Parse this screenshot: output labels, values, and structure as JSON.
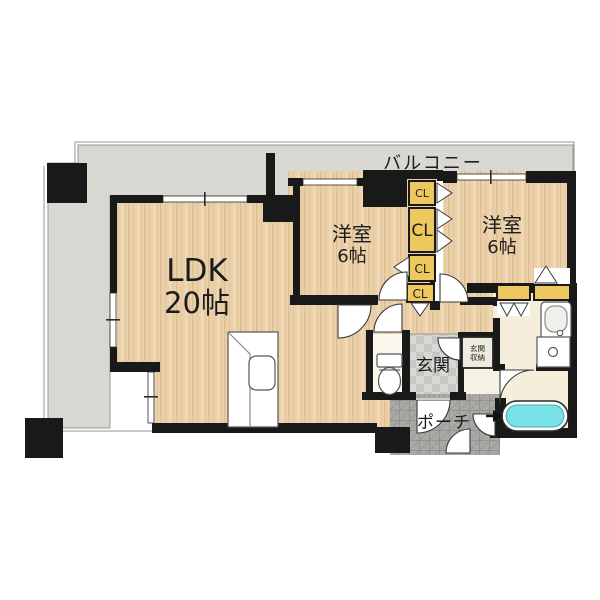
{
  "plan": {
    "balcony": {
      "label": "バルコニー"
    },
    "ldk": {
      "name": "LDK",
      "size": "20帖"
    },
    "bedroom_left": {
      "name": "洋室",
      "size": "6帖"
    },
    "bedroom_right": {
      "name": "洋室",
      "size": "6帖"
    },
    "closets": {
      "cl1": "CL",
      "cl2": "CL",
      "cl3": "CL",
      "cl4": "CL"
    },
    "entrance": {
      "label": "玄関"
    },
    "entrance_storage": {
      "label": "玄関収納",
      "line1": "玄関",
      "line2": "収納"
    },
    "porch": {
      "label": "ポーチ"
    }
  },
  "colors": {
    "wall": "#191919",
    "wood_floor": "#eacfa7",
    "balcony_gray": "#d8d7d2",
    "closet_yellow": "#eec85e",
    "cream_floor": "#f4eeda",
    "bathtub_water": "#79e2e6",
    "entrance_tile": "#d9d8d5",
    "porch_tile": "#aaa9a6"
  }
}
